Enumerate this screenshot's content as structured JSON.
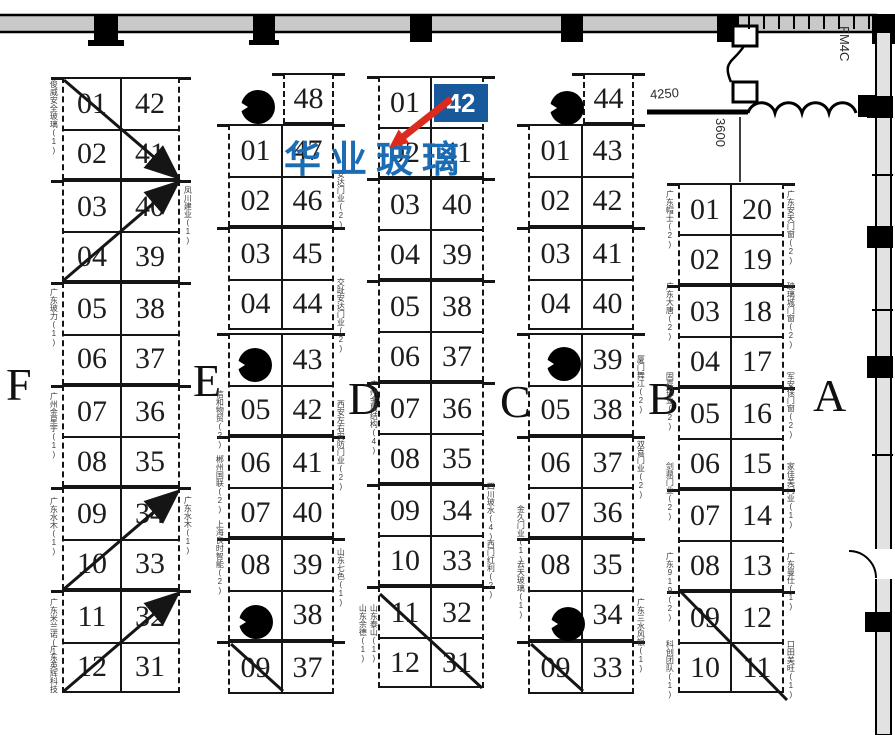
{
  "highlight": {
    "badge_label": "42",
    "company": "华业玻璃",
    "badge_color": "#18599b",
    "company_color": "#1c6cb4",
    "arrow_color": "#dc2a1e",
    "badge_x": 434,
    "badge_y": 84,
    "badge_w": 54,
    "badge_h": 38,
    "company_x": 284,
    "company_y": 141
  },
  "area_labels": [
    {
      "t": "F",
      "x": 6,
      "y": 362
    },
    {
      "t": "E",
      "x": 193,
      "y": 358
    },
    {
      "t": "D",
      "x": 348,
      "y": 376
    },
    {
      "t": "C",
      "x": 500,
      "y": 379
    },
    {
      "t": "B",
      "x": 648,
      "y": 376
    },
    {
      "t": "A",
      "x": 813,
      "y": 373
    }
  ],
  "dimensions": [
    {
      "t": "4250",
      "x": 650,
      "y": 87,
      "mode": "h",
      "rot": -4
    },
    {
      "t": "3600",
      "x": 714,
      "y": 118,
      "mode": "v",
      "rot": 0
    },
    {
      "t": "FM4C",
      "x": 838,
      "y": 26,
      "mode": "v",
      "rot": 0
    }
  ],
  "pillars": [
    {
      "x": 241,
      "y": 90
    },
    {
      "x": 238,
      "y": 348
    },
    {
      "x": 239,
      "y": 605
    },
    {
      "x": 550,
      "y": 91
    },
    {
      "x": 547,
      "y": 347
    },
    {
      "x": 551,
      "y": 607
    }
  ],
  "columns": [
    {
      "id": "F",
      "x": 62,
      "w": 118,
      "divider": 122,
      "blocks": [
        {
          "y": 77,
          "h": 103,
          "rows": [
            [
              "01",
              "42"
            ],
            [
              "02",
              "41"
            ]
          ]
        },
        {
          "y": 180,
          "h": 102,
          "rows": [
            [
              "03",
              "40"
            ],
            [
              "04",
              "39"
            ]
          ]
        },
        {
          "y": 282,
          "h": 103,
          "rows": [
            [
              "05",
              "38"
            ],
            [
              "06",
              "37"
            ]
          ]
        },
        {
          "y": 385,
          "h": 102,
          "rows": [
            [
              "07",
              "36"
            ],
            [
              "08",
              "35"
            ]
          ]
        },
        {
          "y": 487,
          "h": 103,
          "rows": [
            [
              "09",
              "34"
            ],
            [
              "10",
              "33"
            ]
          ]
        },
        {
          "y": 590,
          "h": 103,
          "rows": [
            [
              "11",
              "32"
            ],
            [
              "12",
              "31"
            ]
          ]
        }
      ]
    },
    {
      "id": "E",
      "x": 228,
      "w": 106,
      "divider": 283,
      "blocks": [
        {
          "y": 73,
          "h": 51,
          "bx": 283,
          "bw": 51,
          "rows": [
            [
              "48"
            ]
          ]
        },
        {
          "y": 124,
          "h": 103,
          "rows": [
            [
              "01",
              "47"
            ],
            [
              "02",
              "46"
            ]
          ]
        },
        {
          "y": 227,
          "h": 103,
          "rows": [
            [
              "03",
              "45"
            ],
            [
              "04",
              "44"
            ]
          ]
        },
        {
          "y": 333,
          "h": 103,
          "rows": [
            [
              "",
              "43"
            ],
            [
              "05",
              "42"
            ]
          ]
        },
        {
          "y": 436,
          "h": 102,
          "rows": [
            [
              "06",
              "41"
            ],
            [
              "07",
              "40"
            ]
          ]
        },
        {
          "y": 538,
          "h": 103,
          "rows": [
            [
              "08",
              "39"
            ],
            [
              "",
              "38"
            ]
          ]
        },
        {
          "y": 641,
          "h": 53,
          "rows": [
            [
              "09",
              "37"
            ]
          ]
        }
      ]
    },
    {
      "id": "D",
      "x": 378,
      "w": 106,
      "divider": 432,
      "blocks": [
        {
          "y": 76,
          "h": 102,
          "rows": [
            [
              "01",
              ""
            ],
            [
              "02",
              "41"
            ]
          ]
        },
        {
          "y": 178,
          "h": 102,
          "rows": [
            [
              "03",
              "40"
            ],
            [
              "04",
              "39"
            ]
          ]
        },
        {
          "y": 280,
          "h": 102,
          "rows": [
            [
              "05",
              "38"
            ],
            [
              "06",
              "37"
            ]
          ]
        },
        {
          "y": 382,
          "h": 102,
          "rows": [
            [
              "07",
              "36"
            ],
            [
              "08",
              "35"
            ]
          ]
        },
        {
          "y": 484,
          "h": 102,
          "rows": [
            [
              "09",
              "34"
            ],
            [
              "10",
              "33"
            ]
          ]
        },
        {
          "y": 586,
          "h": 102,
          "rows": [
            [
              "11",
              "32"
            ],
            [
              "12",
              "31"
            ]
          ]
        }
      ]
    },
    {
      "id": "C",
      "x": 528,
      "w": 106,
      "divider": 583,
      "blocks": [
        {
          "y": 73,
          "h": 51,
          "bx": 583,
          "bw": 51,
          "rows": [
            [
              "44"
            ]
          ]
        },
        {
          "y": 124,
          "h": 103,
          "rows": [
            [
              "01",
              "43"
            ],
            [
              "02",
              "42"
            ]
          ]
        },
        {
          "y": 227,
          "h": 103,
          "rows": [
            [
              "03",
              "41"
            ],
            [
              "04",
              "40"
            ]
          ]
        },
        {
          "y": 333,
          "h": 103,
          "rows": [
            [
              "",
              "39"
            ],
            [
              "05",
              "38"
            ]
          ]
        },
        {
          "y": 436,
          "h": 102,
          "rows": [
            [
              "06",
              "37"
            ],
            [
              "07",
              "36"
            ]
          ]
        },
        {
          "y": 538,
          "h": 103,
          "rows": [
            [
              "08",
              "35"
            ],
            [
              "",
              "34"
            ]
          ]
        },
        {
          "y": 641,
          "h": 53,
          "rows": [
            [
              "09",
              "33"
            ]
          ]
        }
      ]
    },
    {
      "id": "B",
      "x": 678,
      "w": 106,
      "divider": 732,
      "blocks": [
        {
          "y": 183,
          "h": 102,
          "rows": [
            [
              "01",
              "20"
            ],
            [
              "02",
              "19"
            ]
          ]
        },
        {
          "y": 285,
          "h": 102,
          "rows": [
            [
              "03",
              "18"
            ],
            [
              "04",
              "17"
            ]
          ]
        },
        {
          "y": 387,
          "h": 102,
          "rows": [
            [
              "05",
              "16"
            ],
            [
              "06",
              "15"
            ]
          ]
        },
        {
          "y": 489,
          "h": 102,
          "rows": [
            [
              "07",
              "14"
            ],
            [
              "08",
              "13"
            ]
          ]
        },
        {
          "y": 591,
          "h": 102,
          "rows": [
            [
              "09",
              "12"
            ],
            [
              "10",
              "11"
            ]
          ]
        }
      ]
    }
  ],
  "side_labels": [
    {
      "x": 49,
      "y": 80,
      "t": "俊威安全玻璃(1)"
    },
    {
      "x": 49,
      "y": 288,
      "t": "广东玻力(1)"
    },
    {
      "x": 49,
      "y": 392,
      "t": "广州金星宇(1)"
    },
    {
      "x": 49,
      "y": 497,
      "t": "广东水木(1)"
    },
    {
      "x": 49,
      "y": 598,
      "t": "广东米兰诺(1)"
    },
    {
      "x": 49,
      "y": 645,
      "t": "广东英辉科技"
    },
    {
      "x": 183,
      "y": 186,
      "t": "凤川建业(1)"
    },
    {
      "x": 183,
      "y": 496,
      "t": "广东水木(1)"
    },
    {
      "x": 215,
      "y": 390,
      "t": "信和物贸(2)"
    },
    {
      "x": 215,
      "y": 455,
      "t": "郴州国联(2)"
    },
    {
      "x": 215,
      "y": 520,
      "t": "上海良时智能(2)"
    },
    {
      "x": 336,
      "y": 170,
      "t": "安达门业(2)"
    },
    {
      "x": 336,
      "y": 278,
      "t": "交趾安达门业(2)"
    },
    {
      "x": 336,
      "y": 400,
      "t": "西安左右安防门业(2)"
    },
    {
      "x": 336,
      "y": 548,
      "t": "山东七色(1)"
    },
    {
      "x": 369,
      "y": 380,
      "t": "广州金属结构(4)"
    },
    {
      "x": 358,
      "y": 604,
      "t": "山东余德(1)"
    },
    {
      "x": 369,
      "y": 604,
      "t": "山东泰山(1)"
    },
    {
      "x": 486,
      "y": 482,
      "t": "四川玻水(4)"
    },
    {
      "x": 486,
      "y": 540,
      "t": "西门红利(2)"
    },
    {
      "x": 516,
      "y": 505,
      "t": "金久门业(1)"
    },
    {
      "x": 516,
      "y": 560,
      "t": "云天玻璃(1)"
    },
    {
      "x": 636,
      "y": 355,
      "t": "厦门舞江(2)"
    },
    {
      "x": 636,
      "y": 440,
      "t": "双喜门业(2)"
    },
    {
      "x": 636,
      "y": 598,
      "t": "广东三水风银(1)"
    },
    {
      "x": 665,
      "y": 190,
      "t": "广东帽士(2)"
    },
    {
      "x": 665,
      "y": 282,
      "t": "广东大唐(2)"
    },
    {
      "x": 665,
      "y": 372,
      "t": "固嘉铝业(2)"
    },
    {
      "x": 665,
      "y": 462,
      "t": "剑鼎门业(2)"
    },
    {
      "x": 665,
      "y": 552,
      "t": "广东919(2)"
    },
    {
      "x": 665,
      "y": 640,
      "t": "科创团队(1)"
    },
    {
      "x": 786,
      "y": 190,
      "t": "广东安天门窗(2)"
    },
    {
      "x": 786,
      "y": 282,
      "t": "玻璃城门窗(2)"
    },
    {
      "x": 786,
      "y": 372,
      "t": "军安保门窗(2)"
    },
    {
      "x": 786,
      "y": 462,
      "t": "家佳美门业(1)"
    },
    {
      "x": 786,
      "y": 552,
      "t": "广东曼仕(1)"
    },
    {
      "x": 786,
      "y": 640,
      "t": "口田美旺(1)"
    }
  ],
  "annotations": {
    "diagonals": [
      {
        "x1": 64,
        "y1": 80,
        "x2": 176,
        "y2": 176,
        "arrow": true
      },
      {
        "x1": 64,
        "y1": 280,
        "x2": 176,
        "y2": 184,
        "arrow": true
      },
      {
        "x1": 64,
        "y1": 589,
        "x2": 176,
        "y2": 493,
        "arrow": true
      },
      {
        "x1": 64,
        "y1": 691,
        "x2": 176,
        "y2": 595,
        "arrow": true
      },
      {
        "x1": 231,
        "y1": 644,
        "x2": 283,
        "y2": 691,
        "arrow": false
      },
      {
        "x1": 380,
        "y1": 594,
        "x2": 482,
        "y2": 688,
        "arrow": false
      },
      {
        "x1": 531,
        "y1": 644,
        "x2": 583,
        "y2": 691,
        "arrow": false
      },
      {
        "x1": 681,
        "y1": 592,
        "x2": 787,
        "y2": 700,
        "arrow": false
      }
    ],
    "red_arrow": {
      "x1": 451,
      "y1": 99,
      "tip_x": 389,
      "tip_y": 148
    }
  }
}
